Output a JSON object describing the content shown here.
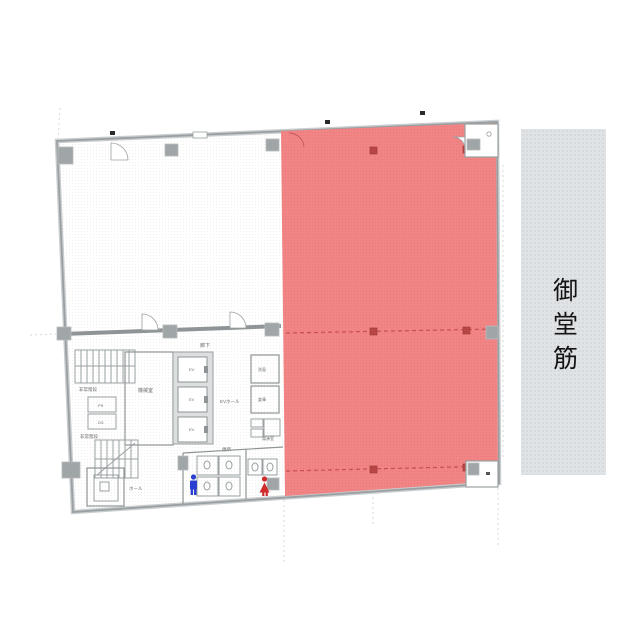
{
  "street_band": {
    "label": "御堂筋"
  },
  "floorplan": {
    "highlight_color": "#f18585",
    "highlight_grid_color": "#c84f4f",
    "band_color": "#e0e3e5",
    "wall_color": "#9aa0a2",
    "labels": {
      "corridor": "廊下",
      "machine_room": "機械室",
      "ev_hall": "EVホール",
      "hall": "ホール",
      "toilet": "便所",
      "pantry": "湯沸室",
      "stairs_upper": "非常階段",
      "stairs_lower": "非常階段",
      "ev1": "EV",
      "ev2": "EV",
      "ev3": "EV",
      "shaft1": "PS",
      "shaft2": "DS",
      "room_a": "洗面",
      "room_b": "倉庫"
    }
  }
}
